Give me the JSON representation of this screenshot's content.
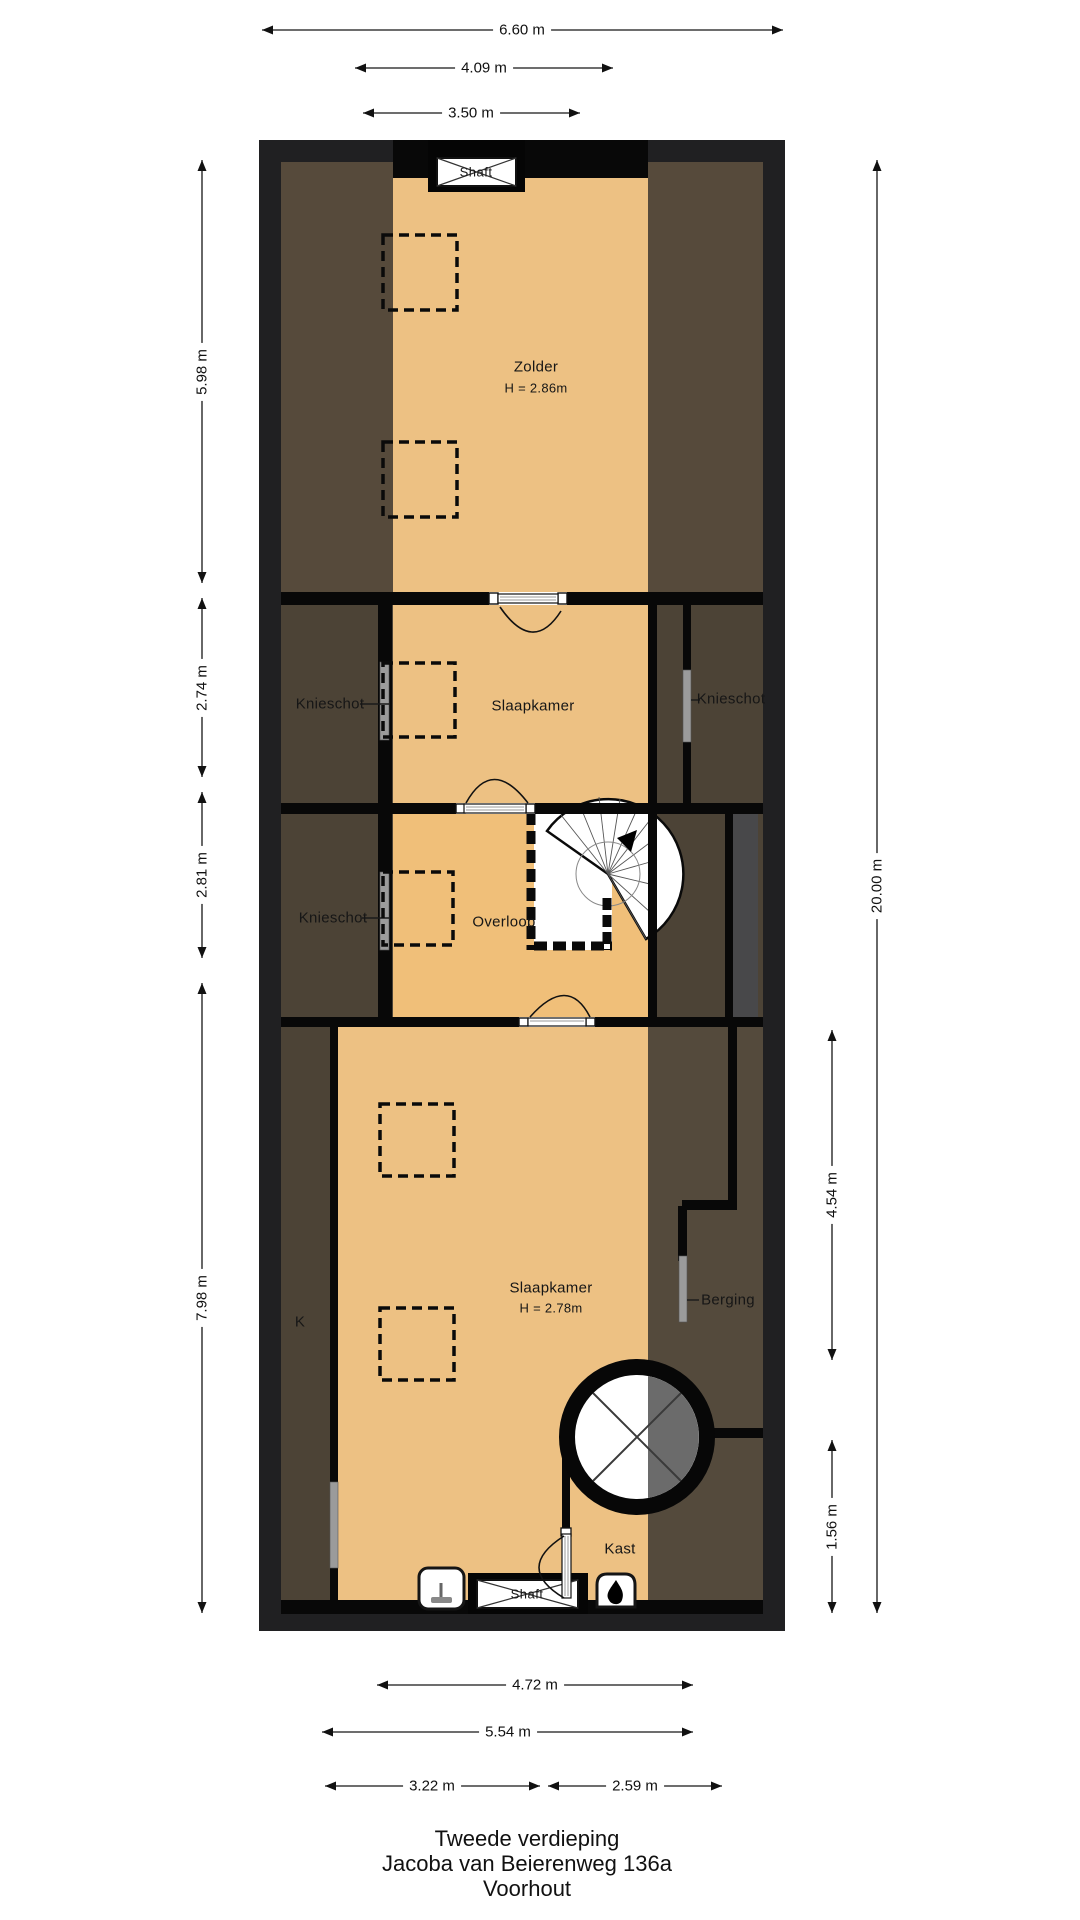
{
  "title": {
    "line1": "Tweede verdieping",
    "line2": "Jacoba van Beierenweg 136a",
    "line3": "Voorhout"
  },
  "rooms": {
    "zolder": {
      "label": "Zolder",
      "ceiling": "H = 2.86m"
    },
    "slaapkamer_boven": {
      "label": "Slaapkamer"
    },
    "knieschot_links_1": {
      "label": "Knieschot"
    },
    "knieschot_rechts": {
      "label": "Knieschot"
    },
    "knieschot_links_2": {
      "label": "Knieschot"
    },
    "overloop": {
      "label": "Overloop"
    },
    "slaapkamer_onder": {
      "label": "Slaapkamer",
      "ceiling": "H = 2.78m"
    },
    "k": {
      "label": "K"
    },
    "berging": {
      "label": "Berging"
    },
    "kast": {
      "label": "Kast"
    },
    "shaft_boven": {
      "label": "Shaft"
    },
    "shaft_onder": {
      "label": "Shaft"
    }
  },
  "dimensions": {
    "w_total": "6.60 m",
    "w_inner": "4.09 m",
    "w_room": "3.50 m",
    "h_zolder": "5.98 m",
    "h_slaapkamer": "2.74 m",
    "h_overloop": "2.81 m",
    "h_slaapkamer2": "7.98 m",
    "h_total": "20.00 m",
    "h_berging": "4.54 m",
    "h_kast": "1.56 m",
    "b_room": "4.72 m",
    "b_inner": "5.54 m",
    "b_left": "3.22 m",
    "b_right": "2.59 m"
  },
  "colors": {
    "floor_tan": "#edc183",
    "floor_overloop": "#f0bf79",
    "roof_brown": "#564a3b",
    "roof_brown_dark": "#4c4336",
    "berging_brown": "#544a3c",
    "grey_zone": "#48484a",
    "wall_black": "#080808",
    "outer_wall": "#202022",
    "stair_grey": "#6b6b6b"
  }
}
